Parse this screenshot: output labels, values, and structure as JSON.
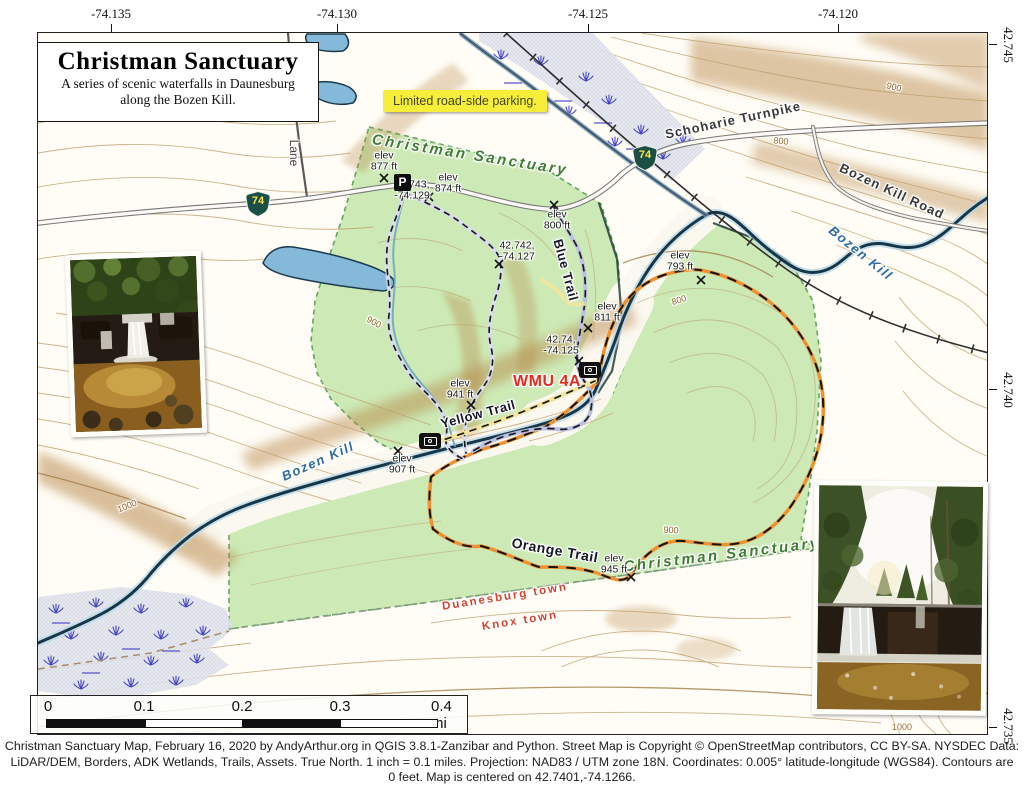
{
  "title_box": {
    "title": "Christman Sanctuary",
    "subtitle1": "A series of scenic waterfalls in Daunesburg",
    "subtitle2": "along the Bozen Kill."
  },
  "axes": {
    "top": [
      "-74.135",
      "-74.130",
      "-74.125",
      "-74.120"
    ],
    "right": [
      "42.745",
      "42.740",
      "42.735"
    ]
  },
  "note": "Limited road-side parking.",
  "labels": {
    "sanctuary_north": "Christman Sanctuary",
    "sanctuary_south": "Christman Sanctuary",
    "bozen_kill_west": "Bozen Kill",
    "bozen_kill_east": "Bozen Kill",
    "schoharie_turnpike": "Schoharie Turnpike",
    "bozen_kill_road": "Bozen Kill Road",
    "lane": "Lane",
    "blue_trail": "Blue Trail",
    "yellow_trail": "Yellow Trail",
    "orange_trail": "Orange Trail",
    "wmu": "WMU 4A",
    "duanesburg_town": "Duanesburg town",
    "knox_town": "Knox town"
  },
  "route_shield": "74",
  "parking_icon": "P",
  "elev_points": [
    {
      "line1": "elev",
      "line2": "877 ft"
    },
    {
      "line1": "elev",
      "line2": "874 ft"
    },
    {
      "line1": "elev",
      "line2": "800 ft"
    },
    {
      "line1": "elev",
      "line2": "793 ft"
    },
    {
      "line1": "elev",
      "line2": "811 ft"
    },
    {
      "line1": "elev",
      "line2": "941 ft"
    },
    {
      "line1": "elev",
      "line2": "907 ft"
    },
    {
      "line1": "elev",
      "line2": "945 ft"
    }
  ],
  "coord_points": [
    {
      "line1": "42.743,",
      "line2": "-74.129"
    },
    {
      "line1": "42.742,",
      "line2": "-74.127"
    },
    {
      "line1": "42.74,",
      "line2": "-74.125"
    }
  ],
  "contour_labels": [
    "900",
    "800",
    "800",
    "900",
    "1000",
    "900",
    "1000"
  ],
  "scalebar": {
    "ticks": [
      "0",
      "0.1",
      "0.2",
      "0.3"
    ],
    "last": "0.4 mi"
  },
  "footer": {
    "line1": "Christman Sanctuary Map, February 16, 2020 by AndyArthur.org in QGIS 3.8.1-Zanzibar and Python. Street Map is Copyright © OpenStreetMap contributors, CC BY-SA. NYSDEC Data:",
    "line2": "LiDAR/DEM, Borders, ADK Wetlands, Trails, Assets. True North. 1 inch = 0.1 miles. Projection: NAD83 / UTM zone 18N. Coordinates: 0.005° latitude-longitude (WGS84). Contours are",
    "line3": "0 feet. Map is centered on 42.7401,-74.1266."
  },
  "colors": {
    "green_area": "#cdeab6",
    "water": "#85b9da",
    "stream_dark": "#173648",
    "orange_trail": "#ee9130",
    "blue_trail_casing": "#bcc0e4",
    "yellow_trail": "#f2e49c",
    "wmu_red": "#e52b20",
    "note_bg": "#f6ee3b",
    "contour": "#bf9a67"
  }
}
